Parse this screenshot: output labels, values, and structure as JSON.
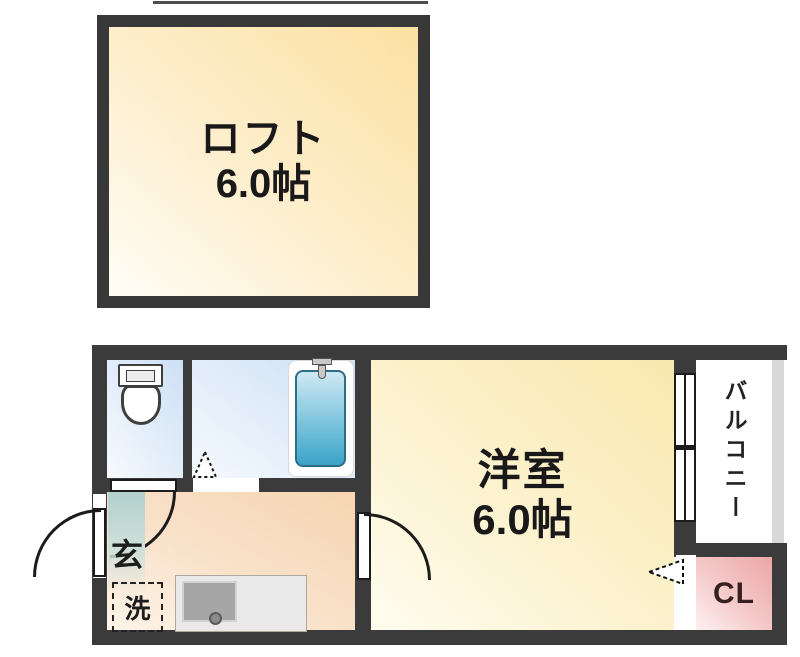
{
  "plan": {
    "loft": {
      "name": "ロフト",
      "size": "6.0帖"
    },
    "rooms": {
      "main": {
        "name": "洋室",
        "size": "6.0帖"
      },
      "balcony": {
        "name": "バルコニー"
      },
      "closet": {
        "name": "CL"
      },
      "entrance": {
        "name": "玄"
      },
      "laundry": {
        "name": "洗"
      }
    },
    "icons": {
      "toilet": "toilet-icon",
      "bathtub": "bathtub-icon",
      "bath_faucet": "faucet-icon",
      "kitchen_counter": "kitchen-sink-icon",
      "swing_doors": "door-swing-arc-icon",
      "bath_door": "folding-door-triangle-icon",
      "closet_opening": "opening-arrow-icon",
      "window": "sliding-window-icon"
    },
    "colors": {
      "wall": "#3b3b3b",
      "loft_fill": "#fbe1a1",
      "main_room_fill": "#f9e8ae",
      "kitchen_fill": "#f6d5b2",
      "wet_room_fill": "#cde0f5",
      "bathtub_fill": "#3ba4c9",
      "entrance_fill": "#b2d0cc",
      "closet_fill": "#eca6a6",
      "balcony_rail": "#d8d8d8",
      "counter_fill": "#e9e9e9",
      "sink_fill": "#a6a6a6"
    }
  }
}
